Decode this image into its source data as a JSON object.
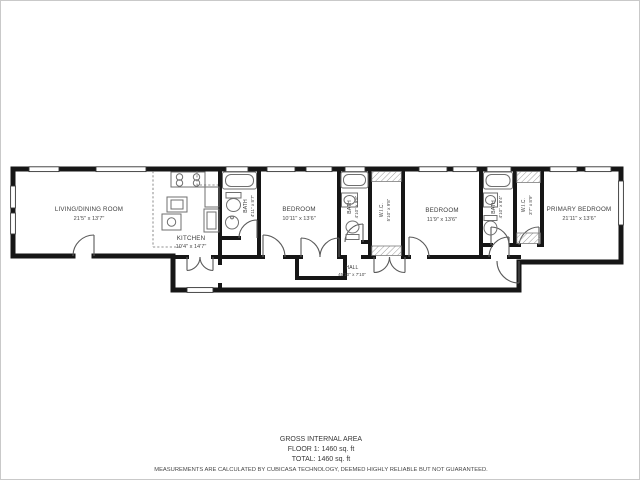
{
  "rooms": {
    "living": {
      "name": "LIVING/DINING ROOM",
      "dims": "21'5\" x 13'7\""
    },
    "kitchen": {
      "name": "KITCHEN",
      "dims": "10'4\" x 14'7\""
    },
    "bath1": {
      "name": "BATH",
      "dims": "4'11\" x 8'7\""
    },
    "bedroom1": {
      "name": "BEDROOM",
      "dims": "10'11\" x 13'6\""
    },
    "bath2": {
      "name": "BATH",
      "dims": "4'10\" x 9'8\""
    },
    "wic1": {
      "name": "W.I.C.",
      "dims": "5'10\" x 9'8\""
    },
    "bedroom2": {
      "name": "BEDROOM",
      "dims": "11'9\" x 13'6\""
    },
    "bath3": {
      "name": "BATH",
      "dims": "4'10\" x 8'4\""
    },
    "wic2": {
      "name": "W.I.C.",
      "dims": "3'7\" x 8'9\""
    },
    "primary": {
      "name": "PRIMARY BEDROOM",
      "dims": "21'11\" x 13'6\""
    },
    "hall": {
      "name": "HALL",
      "dims": "45'10\" x 7'10\""
    }
  },
  "footer": {
    "line1": "GROSS INTERNAL AREA",
    "line2": "FLOOR 1: 1460 sq. ft",
    "line3": "TOTAL: 1460 sq. ft",
    "disclaimer": "MEASUREMENTS ARE CALCULATED BY CUBICASA TECHNOLOGY, DEEMED HIGHLY RELIABLE BUT NOT GUARANTEED."
  },
  "colors": {
    "wall": "#161616",
    "fixture": "#6f6f6f",
    "door": "#5a5a5a",
    "text": "#3d3d3d",
    "page_border": "#c9c9c9"
  }
}
